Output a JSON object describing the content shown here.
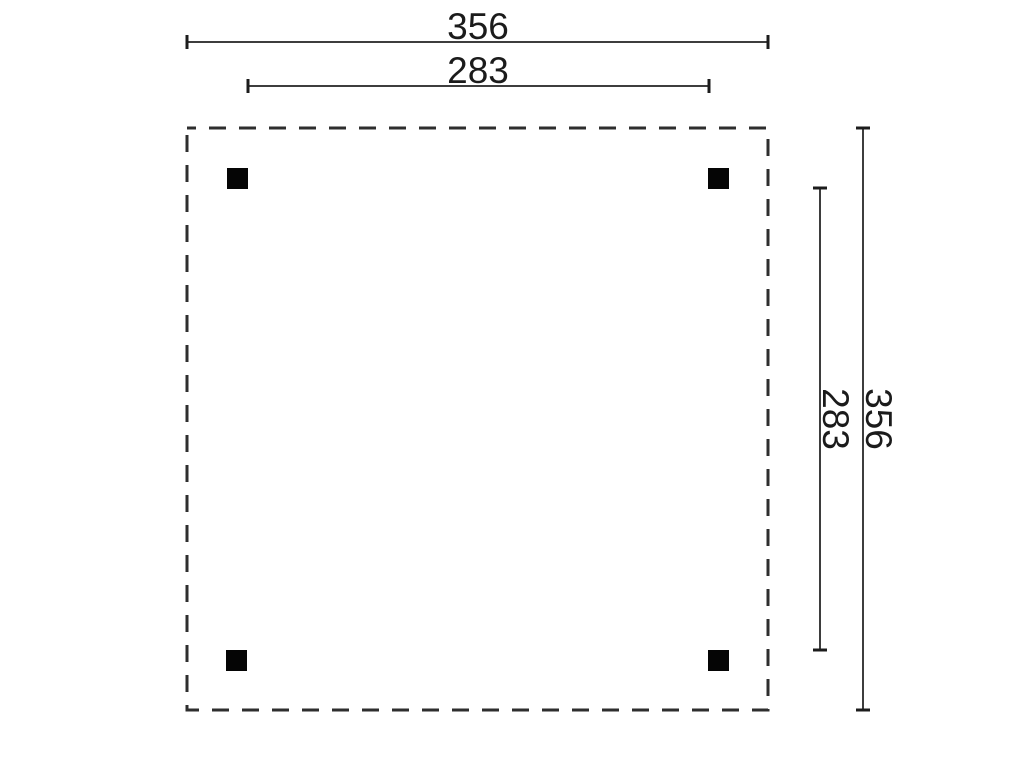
{
  "colors": {
    "background": "#ffffff",
    "line": "#2e2e2e",
    "dimension_line": "#3d3d3d",
    "tick": "#1c1c1c",
    "post": "#050505",
    "text": "#1b1b1b"
  },
  "plan": {
    "description": "Square floor plan with dashed outline and four corner posts",
    "dimensions": {
      "top_outer": {
        "label": "356"
      },
      "top_inner": {
        "label": "283"
      },
      "right_outer": {
        "label": "356"
      },
      "right_inner": {
        "label": "283"
      }
    }
  }
}
